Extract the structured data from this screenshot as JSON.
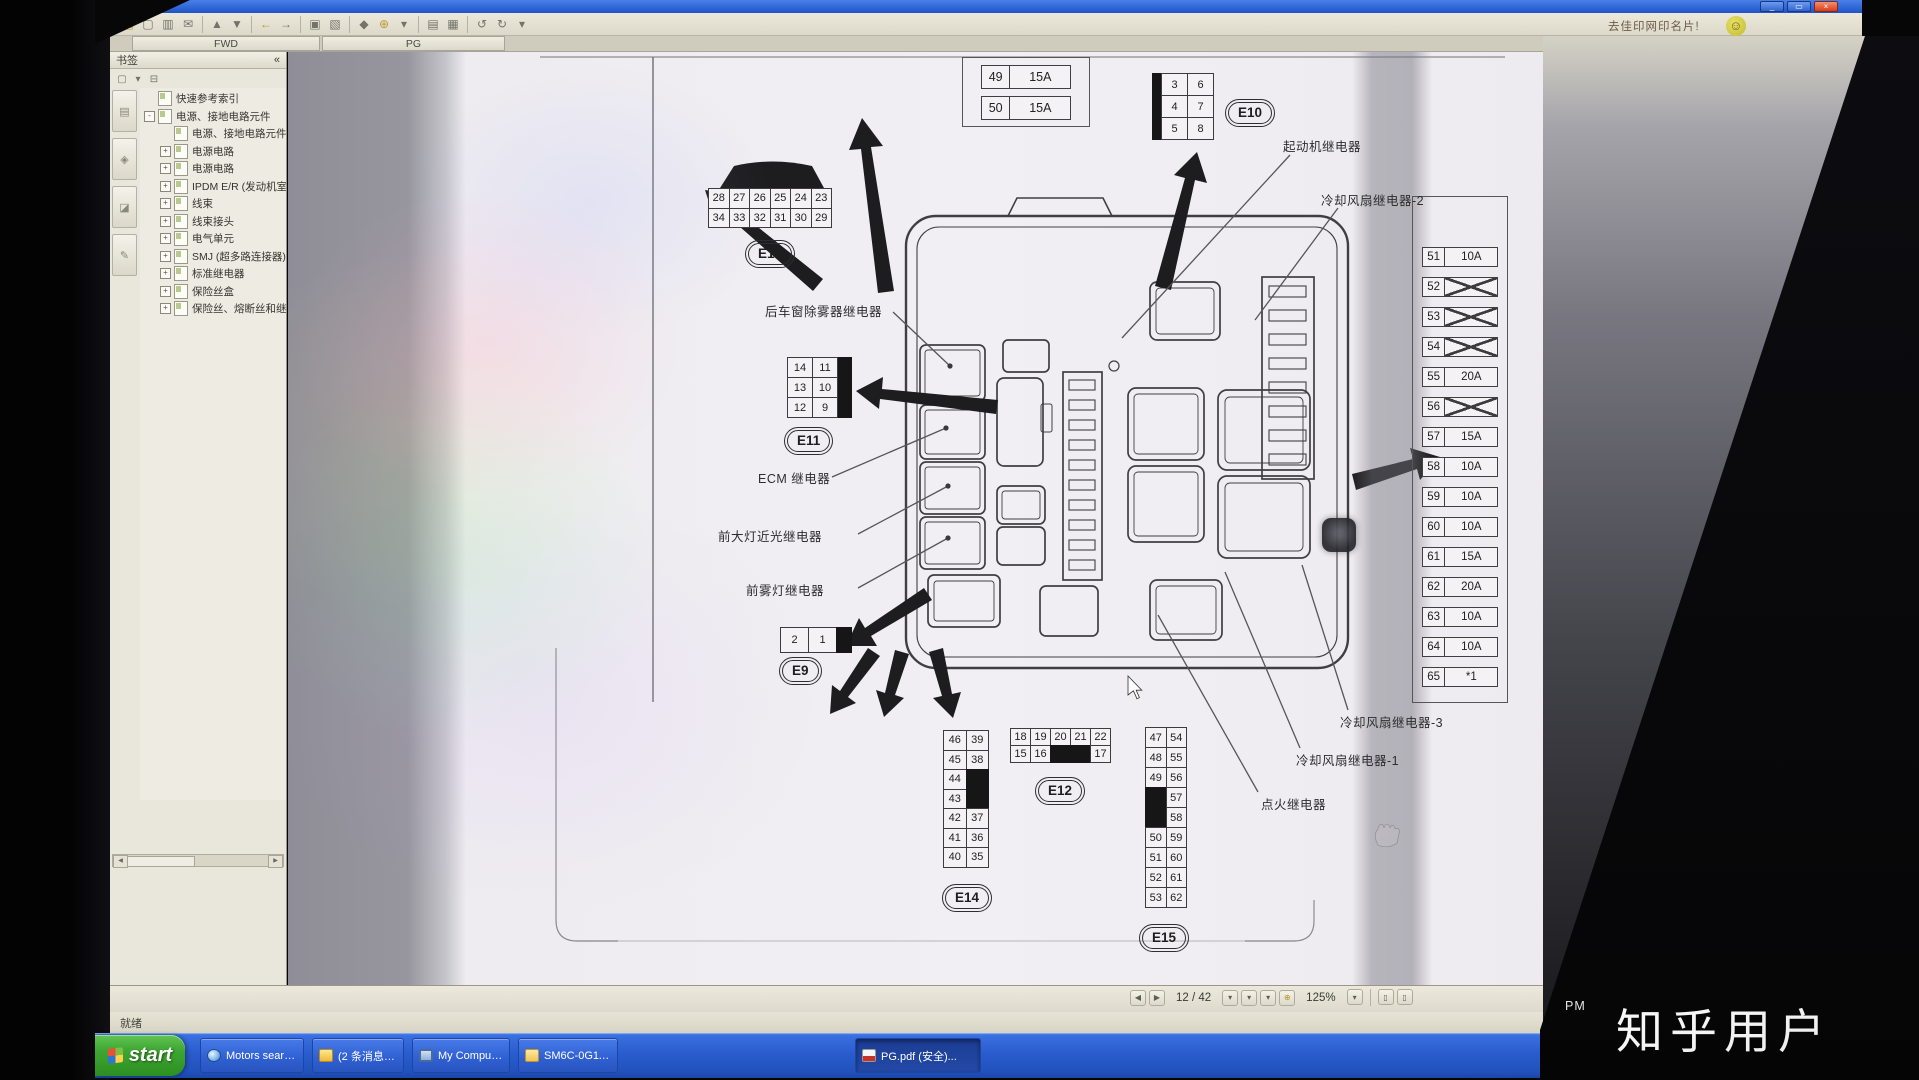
{
  "window": {
    "ad_note": "去佳印网印名片!",
    "controls": {
      "minimize": "_",
      "restore": "▭",
      "close": "×"
    }
  },
  "toolbar": {
    "icons": [
      {
        "g": "▤",
        "name": "open",
        "c": "warm"
      },
      {
        "g": "▢",
        "name": "save"
      },
      {
        "g": "▥",
        "name": "print"
      },
      {
        "g": "✉",
        "name": "email"
      },
      {
        "sep": 1
      },
      {
        "g": "▲",
        "name": "previous-view"
      },
      {
        "g": "▼",
        "name": "next-view"
      },
      {
        "sep": 1
      },
      {
        "g": "←",
        "name": "back",
        "c": "warm"
      },
      {
        "g": "→",
        "name": "forward"
      },
      {
        "sep": 1
      },
      {
        "g": "▣",
        "name": "select-tool"
      },
      {
        "g": "▧",
        "name": "snapshot-tool"
      },
      {
        "sep": 1
      },
      {
        "g": "◆",
        "name": "hand-tool"
      },
      {
        "g": "⊕",
        "name": "zoom-in-tool",
        "c": "warm"
      },
      {
        "g": "▾",
        "name": "zoom-menu"
      },
      {
        "sep": 1
      },
      {
        "g": "▤",
        "name": "single-page-layout"
      },
      {
        "g": "▦",
        "name": "continuous-layout"
      },
      {
        "sep": 1
      },
      {
        "g": "↺",
        "name": "rotate-left"
      },
      {
        "g": "↻",
        "name": "rotate-right"
      },
      {
        "g": "▾",
        "name": "rotate-menu"
      }
    ]
  },
  "tabs": [
    {
      "label": "FWD"
    },
    {
      "label": "PG",
      "active": true
    }
  ],
  "bookmarks_panel": {
    "title": "书签",
    "collapse_icon": "«",
    "tools": [
      {
        "g": "▢",
        "name": "bookmark-options"
      },
      {
        "g": "▾",
        "name": "options-menu"
      },
      {
        "g": "⊟",
        "name": "collapse-all"
      }
    ],
    "nav_tabs": [
      {
        "g": "▤",
        "name": "pages-panel"
      },
      {
        "g": "◈",
        "name": "bookmarks-panel"
      },
      {
        "g": "◪",
        "name": "layers-panel"
      },
      {
        "g": "✎",
        "name": "comments-panel"
      }
    ],
    "items": [
      {
        "label": "快速参考索引",
        "level": 0,
        "exp": ""
      },
      {
        "label": "电源、接地电路元件",
        "level": 0,
        "exp": "-"
      },
      {
        "label": "电源、接地电路元件",
        "level": 1,
        "exp": ""
      },
      {
        "label": "电源电路",
        "level": 1,
        "exp": "+"
      },
      {
        "label": "电源电路",
        "level": 1,
        "exp": "+"
      },
      {
        "label": "IPDM E/R (发动机室智能配电模块)",
        "level": 1,
        "exp": "+"
      },
      {
        "label": "线束",
        "level": 1,
        "exp": "+"
      },
      {
        "label": "线束接头",
        "level": 1,
        "exp": "+"
      },
      {
        "label": "电气单元",
        "level": 1,
        "exp": "+"
      },
      {
        "label": "SMJ (超多路连接器)",
        "level": 1,
        "exp": "+"
      },
      {
        "label": "标准继电器",
        "level": 1,
        "exp": "+"
      },
      {
        "label": "保险丝盒",
        "level": 1,
        "exp": "+"
      },
      {
        "label": "保险丝、熔断丝和继电器",
        "level": 1,
        "exp": "+"
      }
    ]
  },
  "diagram": {
    "connectors": {
      "e13": {
        "id": "E13",
        "rows": [
          [
            "28",
            "27",
            "26",
            "25",
            "24",
            "23"
          ],
          [
            "34",
            "33",
            "32",
            "31",
            "30",
            "29"
          ]
        ]
      },
      "e11": {
        "id": "E11",
        "rows": [
          [
            "14",
            "11"
          ],
          [
            "13",
            "10"
          ],
          [
            "12",
            "9"
          ]
        ]
      },
      "e9": {
        "id": "E9",
        "rows": [
          [
            "2",
            "1",
            "#B#"
          ]
        ]
      },
      "e10": {
        "id": "E10",
        "rows": [
          [
            "3",
            "6"
          ],
          [
            "4",
            "7"
          ],
          [
            "5",
            "8"
          ]
        ]
      },
      "e14": {
        "id": "E14",
        "rows": [
          [
            "46",
            "39"
          ],
          [
            "45",
            "38"
          ],
          [
            "44",
            "#B#"
          ],
          [
            "43",
            "#B#"
          ],
          [
            "42",
            "37"
          ],
          [
            "41",
            "36"
          ],
          [
            "40",
            "35"
          ]
        ]
      },
      "e12": {
        "id": "E12",
        "rows": [
          [
            "18",
            "19",
            "20",
            "21",
            "22"
          ],
          [
            "15",
            "16",
            "#B#",
            "#B#",
            "17"
          ]
        ]
      },
      "e15": {
        "id": "E15",
        "rows": [
          [
            "47",
            "54"
          ],
          [
            "48",
            "55"
          ],
          [
            "49",
            "56"
          ],
          [
            "#B#",
            "57"
          ],
          [
            "#B#",
            "58"
          ],
          [
            "50",
            "59"
          ],
          [
            "51",
            "60"
          ],
          [
            "52",
            "61"
          ],
          [
            "53",
            "62"
          ]
        ]
      }
    },
    "top_fuses": [
      {
        "num": "49",
        "amp": "15A"
      },
      {
        "num": "50",
        "amp": "15A"
      }
    ],
    "fuse_table": [
      {
        "num": "51",
        "amp": "10A"
      },
      {
        "num": "52",
        "amp": "#X#"
      },
      {
        "num": "53",
        "amp": "#X#"
      },
      {
        "num": "54",
        "amp": "#X#"
      },
      {
        "num": "55",
        "amp": "20A"
      },
      {
        "num": "56",
        "amp": "#X#"
      },
      {
        "num": "57",
        "amp": "15A"
      },
      {
        "num": "58",
        "amp": "10A"
      },
      {
        "num": "59",
        "amp": "10A"
      },
      {
        "num": "60",
        "amp": "10A"
      },
      {
        "num": "61",
        "amp": "15A"
      },
      {
        "num": "62",
        "amp": "20A"
      },
      {
        "num": "63",
        "amp": "10A"
      },
      {
        "num": "64",
        "amp": "10A"
      },
      {
        "num": "65",
        "amp": "*1"
      }
    ],
    "labels": {
      "rear_defogger": "后车窗除雾器继电器",
      "ecm": "ECM 继电器",
      "headlamp_low": "前大灯近光继电器",
      "front_fog": "前雾灯继电器",
      "starter": "起动机继电器",
      "cooling_fan_2": "冷却风扇继电器-2",
      "cooling_fan_3": "冷却风扇继电器-3",
      "cooling_fan_1": "冷却风扇继电器-1",
      "ignition": "点火继电器"
    }
  },
  "status_bar": {
    "page_display": "12 / 42",
    "zoom": "125%",
    "nav_icons": [
      {
        "g": "◀",
        "name": "previous-page"
      },
      {
        "g": "▶",
        "name": "next-page"
      }
    ],
    "mid_icons": [
      {
        "g": "▾",
        "name": "page-view-menu"
      },
      {
        "g": "▾",
        "name": "scroll-mode-menu"
      },
      {
        "g": "▾",
        "name": "display-menu"
      },
      {
        "g": "⊕",
        "name": "zoom-tool",
        "c": "warm"
      }
    ],
    "right_icons": [
      {
        "g": "▾",
        "name": "zoom-level-menu"
      },
      {
        "sep": 1
      },
      {
        "g": "▯",
        "name": "single-page-view"
      },
      {
        "g": "▯",
        "name": "continuous-page-view"
      }
    ]
  },
  "status_text": "就绪",
  "taskbar": {
    "start_label": "start",
    "tasks": [
      {
        "label": "Motors searc...",
        "icon": "globe"
      },
      {
        "label": "(2 条消息)日...",
        "icon": "msg"
      },
      {
        "label": "My Computer",
        "icon": "pc"
      },
      {
        "label": "SM6C-0G11P0",
        "icon": "folder"
      },
      {
        "label": "PG.pdf (安全)...",
        "icon": "pdf",
        "active": true
      }
    ]
  },
  "overlay": {
    "watermark": "知乎用户",
    "osd": "PM"
  }
}
